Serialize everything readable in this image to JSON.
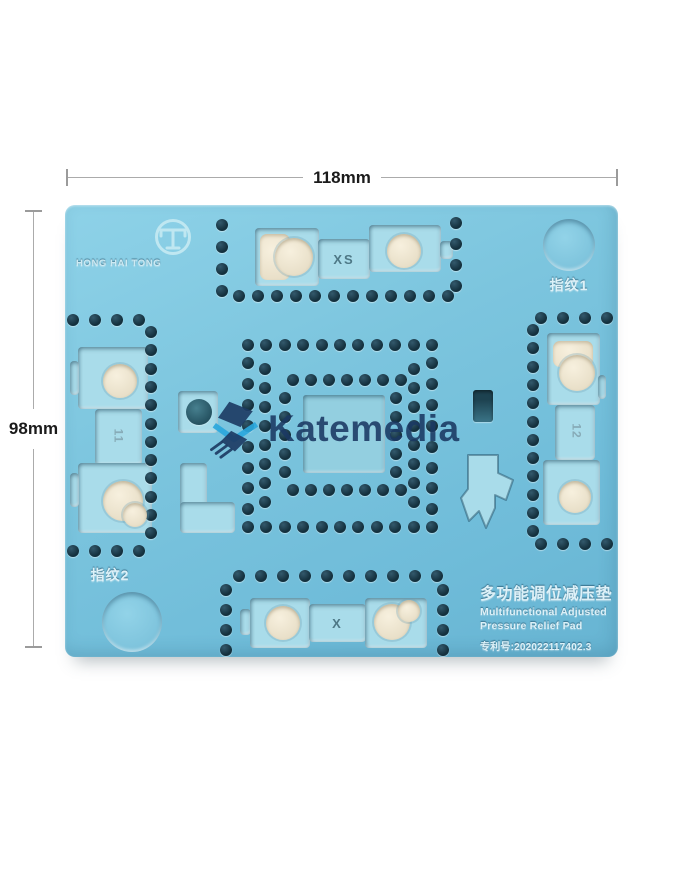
{
  "dimensions": {
    "width_label": "118mm",
    "height_label": "98mm"
  },
  "brand": {
    "name": "HONG HAI TONG"
  },
  "pad_labels": {
    "fingerprint_1": "指纹1",
    "fingerprint_2": "指纹2",
    "size_top": "XS",
    "size_bottom": "X",
    "size_left": "11",
    "size_right": "12"
  },
  "product_info": {
    "title_cn": "多功能调位减压垫",
    "title_en_line1": "Multifunctional Adjusted",
    "title_en_line2": "Pressure Relief Pad",
    "patent_no": "专利号:202022117402.3"
  },
  "watermark": {
    "text": "Katemedia",
    "text_color": "#1d3a5f",
    "accent_color": "#2aa7dc"
  },
  "icons": {
    "brand_logo": "circle-t-emblem-icon",
    "watermark_logo": "chip-icon"
  },
  "colors": {
    "pad_base": "#7cc5de",
    "hole": "#14303d",
    "pocket_floor": "#a9dcea",
    "hole_floor_cream": "#f0e8d5",
    "dimension_line": "#ababab",
    "dimension_text": "#1b1b1b",
    "embossed_text": "#ddf1f8"
  }
}
